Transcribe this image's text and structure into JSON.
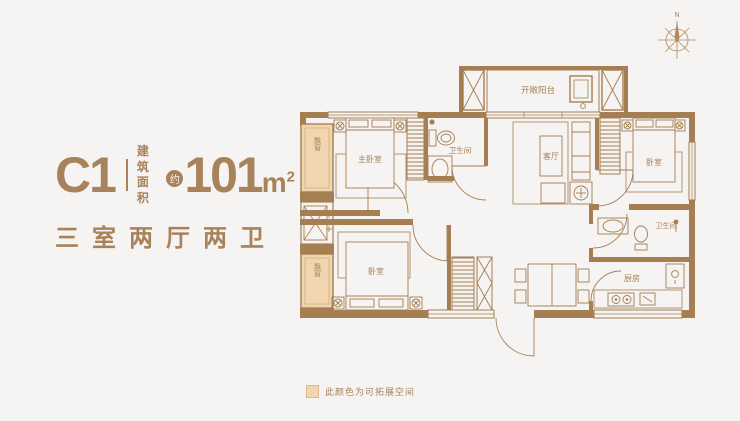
{
  "colors": {
    "accent": "#a8825a",
    "wall": "#a57e52",
    "highlight": "#f0d5ae",
    "background": "#f5f4f2"
  },
  "unit": {
    "code": "C1",
    "area_label_top": "建筑",
    "area_label_bottom": "面积",
    "approx_badge": "约",
    "area_value": "101",
    "area_unit": "m",
    "area_exponent": "2",
    "layout_type": "三室两厅两卫"
  },
  "plan": {
    "balcony_label": "开敞阳台",
    "master_bedroom_label": "主卧室",
    "bathroom_top_label": "卫生间",
    "living_room_label": "客厅",
    "bedroom_right_label": "卧室",
    "bathroom_right_label": "卫生间",
    "kitchen_label": "厨房",
    "bedroom_bottom_label": "卧室",
    "bay_window_top_label": "飘窗",
    "bay_window_bottom_label": "飘窗",
    "compass_north": "N"
  },
  "legend": {
    "note": "此颜色为可拓展空间"
  }
}
